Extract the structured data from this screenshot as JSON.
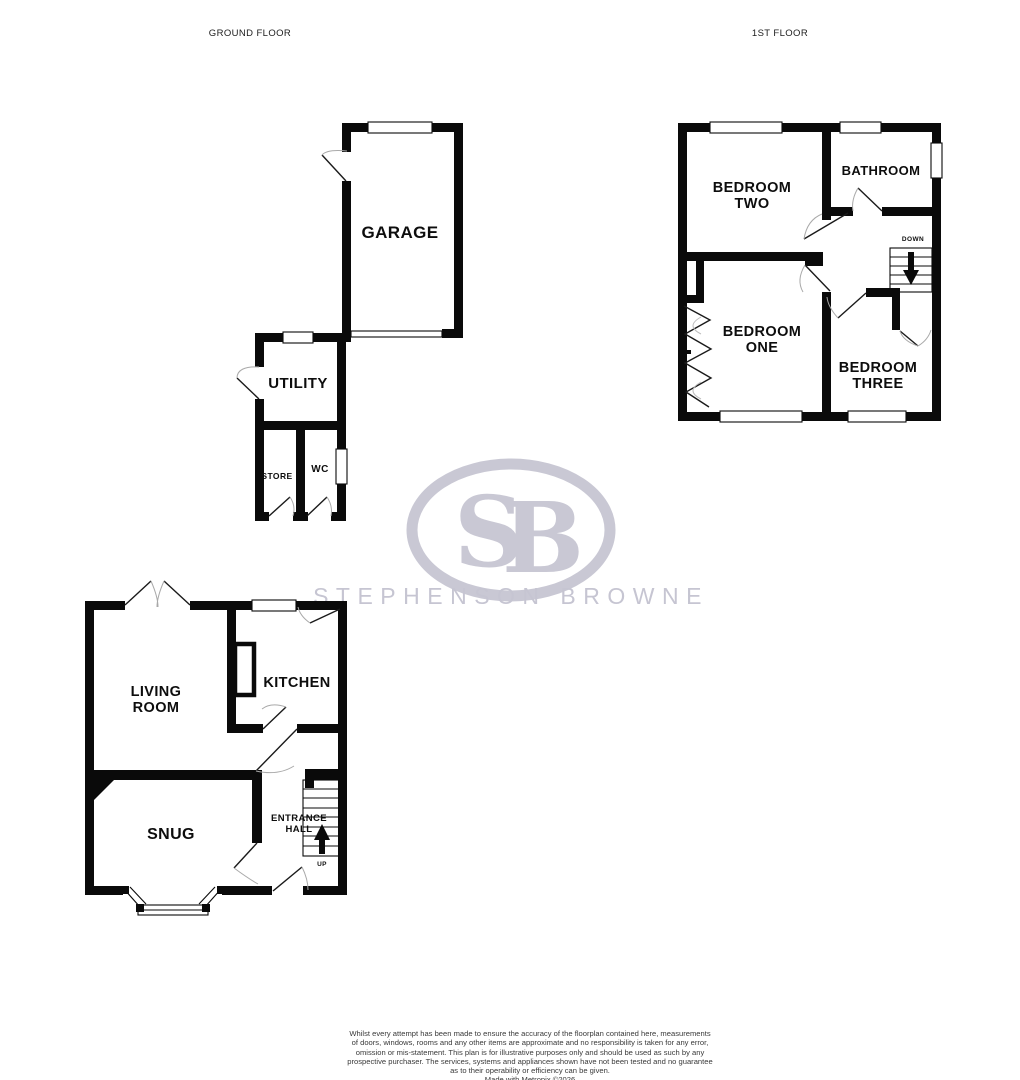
{
  "floors": {
    "ground": "GROUND FLOOR",
    "first": "1ST FLOOR"
  },
  "rooms": {
    "garage": "GARAGE",
    "utility": "UTILITY",
    "store": "STORE",
    "wc": "WC",
    "living_room": [
      "LIVING",
      "ROOM"
    ],
    "kitchen": "KITCHEN",
    "snug": "SNUG",
    "entrance_hall": [
      "ENTRANCE",
      "HALL"
    ],
    "bedroom_two": [
      "BEDROOM",
      "TWO"
    ],
    "bathroom": "BATHROOM",
    "bedroom_one": [
      "BEDROOM",
      "ONE"
    ],
    "bedroom_three": [
      "BEDROOM",
      "THREE"
    ]
  },
  "stairs": {
    "up": "UP",
    "down": "DOWN"
  },
  "watermark": {
    "initial_s": "S",
    "initial_b": "B",
    "name": "STEPHENSON BROWNE",
    "color": "#c9c8d4"
  },
  "colors": {
    "wall": "#0a0a0a",
    "door_arc": "#a9a9a9",
    "background": "#ffffff"
  },
  "disclaimer": [
    "Whilst every attempt has been made to ensure the accuracy of the floorplan contained here, measurements",
    "of doors, windows, rooms and any other items are approximate and no responsibility is taken for any error,",
    "omission or mis-statement. This plan is for illustrative purposes only and should be used as such by any",
    "prospective purchaser. The services, systems and appliances shown have not been tested and no guarantee",
    "as to their operability or efficiency can be given.",
    "Made with Metropix ©2026"
  ]
}
